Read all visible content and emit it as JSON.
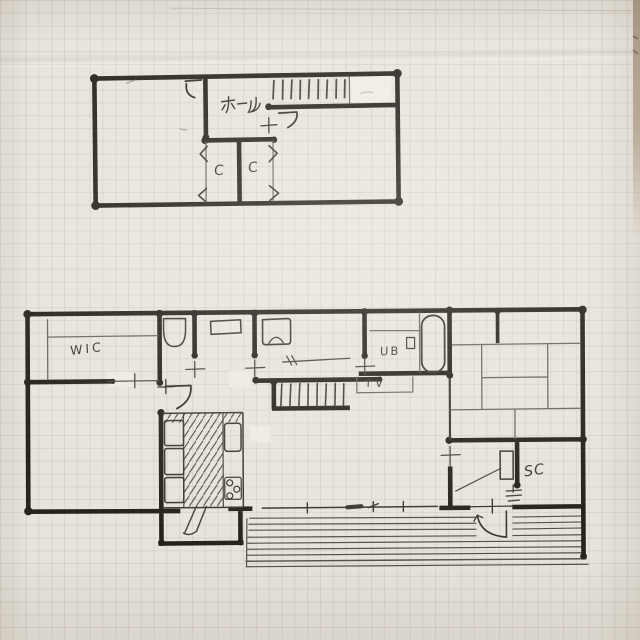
{
  "labels": {
    "floor2_hall": "ホール",
    "floor2_closet_left": "C",
    "floor2_closet_right": "C",
    "floor1_wic": "WIC",
    "floor1_unit_bath": "UB",
    "floor1_tv": "TV",
    "floor1_shoe_closet": "SC"
  },
  "colors": {
    "ink": "#26231d",
    "thin_line": "#5d584d",
    "paper": "#e8e4dc",
    "grid_line": "#c9c2b4",
    "paper_edge": "#ab9a82",
    "correction_tape": "#efece5",
    "pencil": "#9b948a"
  }
}
